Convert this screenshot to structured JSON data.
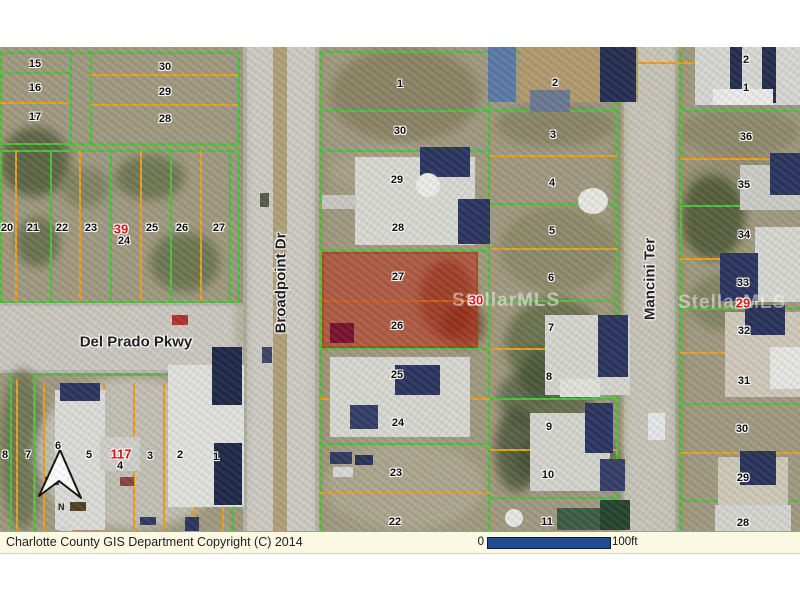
{
  "statusbar": {
    "copyright": "Charlotte County GIS Department Copyright (C) 2014",
    "scale_start": "0",
    "scale_end": "100ft"
  },
  "map": {
    "streets": {
      "broadpoint": "Broadpoint Dr",
      "delprado": "Del Prado Pkwy",
      "mancini": "Mancini Ter"
    },
    "watermark": "StellarMLS",
    "north_label": "N",
    "highlight": {
      "block": "30",
      "lots": [
        "27",
        "26"
      ]
    },
    "colors": {
      "green": "#4dc23f",
      "orange": "#eb9f1e",
      "highlight": "rgba(187,40,18,0.55)",
      "scalebar": "#1e4e90",
      "red_label": "#e00f0f"
    },
    "block_labels": [
      [
        "39",
        121,
        182
      ],
      [
        "117",
        121,
        407
      ],
      [
        "30",
        476,
        253
      ],
      [
        "29",
        743,
        256
      ]
    ],
    "lots": [
      [
        "15",
        35,
        17
      ],
      [
        "16",
        35,
        41
      ],
      [
        "17",
        35,
        70
      ],
      [
        "30",
        165,
        20
      ],
      [
        "29",
        165,
        45
      ],
      [
        "28",
        165,
        72
      ],
      [
        "20",
        7,
        181
      ],
      [
        "21",
        33,
        181
      ],
      [
        "22",
        62,
        181
      ],
      [
        "23",
        91,
        181
      ],
      [
        "24",
        124,
        194
      ],
      [
        "25",
        152,
        181
      ],
      [
        "26",
        182,
        181
      ],
      [
        "27",
        219,
        181
      ],
      [
        "8",
        5,
        408
      ],
      [
        "7",
        28,
        408
      ],
      [
        "6",
        58,
        399
      ],
      [
        "5",
        89,
        408
      ],
      [
        "4",
        120,
        419
      ],
      [
        "3",
        150,
        409
      ],
      [
        "2",
        180,
        408
      ],
      [
        "1",
        216,
        410
      ],
      [
        "1",
        400,
        37
      ],
      [
        "30",
        400,
        84
      ],
      [
        "29",
        397,
        133
      ],
      [
        "28",
        398,
        181
      ],
      [
        "27",
        398,
        230
      ],
      [
        "26",
        397,
        279
      ],
      [
        "25",
        397,
        328
      ],
      [
        "24",
        398,
        376
      ],
      [
        "23",
        396,
        426
      ],
      [
        "22",
        395,
        475
      ],
      [
        "2",
        555,
        36
      ],
      [
        "3",
        553,
        88
      ],
      [
        "4",
        552,
        136
      ],
      [
        "5",
        552,
        184
      ],
      [
        "6",
        551,
        231
      ],
      [
        "7",
        551,
        281
      ],
      [
        "8",
        549,
        330
      ],
      [
        "9",
        549,
        380
      ],
      [
        "10",
        548,
        428
      ],
      [
        "11",
        547,
        475
      ],
      [
        "2",
        746,
        13
      ],
      [
        "1",
        746,
        41
      ],
      [
        "36",
        746,
        90
      ],
      [
        "35",
        744,
        138
      ],
      [
        "34",
        744,
        188
      ],
      [
        "33",
        743,
        236
      ],
      [
        "32",
        744,
        284
      ],
      [
        "31",
        744,
        334
      ],
      [
        "30",
        742,
        382
      ],
      [
        "29",
        743,
        431
      ],
      [
        "28",
        743,
        476
      ]
    ],
    "lines": [
      [
        "g",
        0,
        5,
        240,
        2
      ],
      [
        "g",
        0,
        96,
        240,
        2
      ],
      [
        "g",
        0,
        5,
        2,
        93
      ],
      [
        "g",
        238,
        5,
        2,
        93
      ],
      [
        "g",
        70,
        5,
        2,
        93
      ],
      [
        "g",
        90,
        5,
        2,
        93
      ],
      [
        "g",
        0,
        25,
        70,
        2
      ],
      [
        "o",
        0,
        55,
        70,
        2
      ],
      [
        "o",
        90,
        27,
        148,
        2
      ],
      [
        "o",
        90,
        57,
        148,
        2
      ],
      [
        "g",
        0,
        103,
        240,
        2
      ],
      [
        "g",
        0,
        254,
        240,
        2
      ],
      [
        "g",
        0,
        103,
        2,
        153
      ],
      [
        "g",
        238,
        103,
        2,
        153
      ],
      [
        "o",
        15,
        103,
        2,
        151
      ],
      [
        "g",
        50,
        103,
        2,
        151
      ],
      [
        "o",
        79,
        103,
        2,
        151
      ],
      [
        "g",
        110,
        103,
        2,
        151
      ],
      [
        "o",
        140,
        103,
        2,
        151
      ],
      [
        "g",
        170,
        103,
        2,
        151
      ],
      [
        "o",
        200,
        103,
        2,
        151
      ],
      [
        "g",
        229,
        103,
        2,
        151
      ],
      [
        "g",
        10,
        326,
        2,
        158
      ],
      [
        "o",
        16,
        332,
        2,
        152
      ],
      [
        "o",
        43,
        336,
        2,
        148
      ],
      [
        "o",
        73,
        336,
        2,
        148
      ],
      [
        "o",
        103,
        336,
        2,
        148
      ],
      [
        "o",
        133,
        336,
        2,
        148
      ],
      [
        "o",
        163,
        336,
        2,
        148
      ],
      [
        "o",
        194,
        336,
        2,
        148
      ],
      [
        "o",
        222,
        336,
        2,
        148
      ],
      [
        "g",
        320,
        4,
        2,
        480
      ],
      [
        "g",
        616,
        4,
        2,
        480
      ],
      [
        "g",
        488,
        4,
        2,
        480
      ],
      [
        "g",
        320,
        4,
        298,
        2
      ],
      [
        "g",
        320,
        63,
        170,
        2
      ],
      [
        "g",
        320,
        103,
        170,
        2
      ],
      [
        "o",
        320,
        156,
        170,
        2
      ],
      [
        "g",
        320,
        203,
        170,
        2
      ],
      [
        "o",
        322,
        253,
        156,
        2
      ],
      [
        "g",
        320,
        301,
        170,
        2
      ],
      [
        "o",
        320,
        351,
        170,
        2
      ],
      [
        "g",
        320,
        396,
        170,
        2
      ],
      [
        "o",
        320,
        445,
        170,
        2
      ],
      [
        "g",
        490,
        63,
        128,
        2
      ],
      [
        "o",
        490,
        108,
        128,
        2
      ],
      [
        "g",
        490,
        156,
        128,
        2
      ],
      [
        "o",
        490,
        201,
        128,
        2
      ],
      [
        "g",
        490,
        253,
        128,
        2
      ],
      [
        "o",
        490,
        301,
        128,
        2
      ],
      [
        "g",
        490,
        351,
        128,
        2
      ],
      [
        "o",
        490,
        402,
        128,
        2
      ],
      [
        "g",
        490,
        450,
        128,
        2
      ],
      [
        "g",
        680,
        4,
        2,
        480
      ],
      [
        "o",
        606,
        15,
        194,
        2
      ],
      [
        "g",
        680,
        63,
        120,
        2
      ],
      [
        "o",
        680,
        111,
        120,
        2
      ],
      [
        "g",
        680,
        158,
        120,
        2
      ],
      [
        "o",
        680,
        211,
        120,
        2
      ],
      [
        "g",
        680,
        261,
        120,
        2
      ],
      [
        "o",
        606,
        305,
        16,
        2
      ],
      [
        "o",
        680,
        305,
        120,
        2
      ],
      [
        "g",
        680,
        356,
        120,
        2
      ],
      [
        "o",
        680,
        405,
        120,
        2
      ],
      [
        "g",
        680,
        453,
        120,
        2
      ]
    ],
    "buildings": [
      [
        355,
        110,
        120,
        88,
        "#d9d9d5"
      ],
      [
        420,
        100,
        50,
        30,
        "#2a3560"
      ],
      [
        458,
        152,
        32,
        45,
        "#2a3560"
      ],
      [
        416,
        126,
        24,
        24,
        "#ededea",
        "r"
      ],
      [
        578,
        141,
        30,
        26,
        "#e8e8e4",
        "r"
      ],
      [
        322,
        148,
        34,
        14,
        "#c9c7c0"
      ],
      [
        330,
        310,
        140,
        80,
        "#d8d8d4"
      ],
      [
        395,
        318,
        45,
        30,
        "#2a3560"
      ],
      [
        350,
        358,
        28,
        24,
        "#323c66"
      ],
      [
        330,
        405,
        22,
        12,
        "#303a62"
      ],
      [
        355,
        408,
        18,
        10,
        "#283258"
      ],
      [
        333,
        420,
        20,
        10,
        "#d8d8d8"
      ],
      [
        488,
        0,
        28,
        55,
        "#5b79a8"
      ],
      [
        520,
        0,
        118,
        55,
        "#b29a6d"
      ],
      [
        600,
        0,
        36,
        55,
        "#242e52"
      ],
      [
        530,
        43,
        40,
        22,
        "#6a7894"
      ],
      [
        545,
        268,
        85,
        80,
        "#d6d6d2"
      ],
      [
        598,
        268,
        30,
        62,
        "#2a3560"
      ],
      [
        560,
        332,
        40,
        18,
        "#e2e2de"
      ],
      [
        530,
        366,
        80,
        78,
        "#d4d4d0"
      ],
      [
        585,
        356,
        28,
        50,
        "#2a3560"
      ],
      [
        600,
        412,
        25,
        32,
        "#343e68"
      ],
      [
        557,
        461,
        70,
        22,
        "#3a5c46"
      ],
      [
        600,
        453,
        30,
        30,
        "#24442f"
      ],
      [
        505,
        462,
        18,
        18,
        "#e8e8e8",
        "r"
      ],
      [
        695,
        0,
        105,
        58,
        "#d8d8d5"
      ],
      [
        730,
        0,
        12,
        52,
        "#222c50"
      ],
      [
        762,
        0,
        14,
        56,
        "#222c50"
      ],
      [
        713,
        42,
        60,
        16,
        "#ececea"
      ],
      [
        740,
        118,
        60,
        45,
        "#cdcdc8"
      ],
      [
        770,
        106,
        30,
        42,
        "#2a3560"
      ],
      [
        755,
        180,
        45,
        75,
        "#d7d7d3"
      ],
      [
        720,
        206,
        38,
        48,
        "#2a3560"
      ],
      [
        725,
        265,
        75,
        85,
        "#cfcabb"
      ],
      [
        745,
        258,
        40,
        30,
        "#28325a"
      ],
      [
        770,
        300,
        30,
        42,
        "#e8e8e6"
      ],
      [
        718,
        410,
        70,
        76,
        "#cfc9ba"
      ],
      [
        740,
        404,
        36,
        34,
        "#28325a"
      ],
      [
        648,
        366,
        17,
        27,
        "#e6e8ea"
      ],
      [
        715,
        458,
        76,
        26,
        "#d5d5d1"
      ],
      [
        55,
        343,
        50,
        140,
        "#dcdcda"
      ],
      [
        60,
        336,
        40,
        18,
        "#2a3560"
      ],
      [
        168,
        318,
        76,
        142,
        "#e2e2e0"
      ],
      [
        212,
        300,
        30,
        58,
        "#1e2848"
      ],
      [
        214,
        396,
        28,
        62,
        "#1e2848"
      ],
      [
        100,
        390,
        40,
        34,
        "#d0d0cc"
      ],
      [
        172,
        268,
        16,
        10,
        "#b03030"
      ],
      [
        45,
        430,
        14,
        8,
        "#303a62"
      ],
      [
        70,
        455,
        16,
        9,
        "#50421e"
      ],
      [
        120,
        430,
        14,
        9,
        "#884444"
      ],
      [
        140,
        470,
        16,
        8,
        "#303a62"
      ],
      [
        95,
        500,
        18,
        9,
        "#25304f"
      ],
      [
        150,
        505,
        15,
        8,
        "#c8c8c4"
      ],
      [
        185,
        470,
        14,
        20,
        "#2b355c"
      ],
      [
        60,
        478,
        12,
        8,
        "#d8d8d8"
      ],
      [
        262,
        300,
        10,
        16,
        "#3a4468"
      ],
      [
        260,
        146,
        9,
        14,
        "#555b4a"
      ],
      [
        330,
        276,
        24,
        20,
        "#7a1030"
      ]
    ],
    "veg": [
      [
        0,
        80,
        70,
        70,
        "#4e5a38",
        0.8
      ],
      [
        115,
        108,
        70,
        45,
        "#5d6a42",
        0.7
      ],
      [
        150,
        185,
        70,
        60,
        "#5f6c44",
        0.75
      ],
      [
        15,
        170,
        45,
        50,
        "#56633c",
        0.7
      ],
      [
        60,
        120,
        50,
        40,
        "#6d7850",
        0.6
      ],
      [
        330,
        0,
        150,
        95,
        "#8a8263",
        0.9
      ],
      [
        495,
        55,
        120,
        45,
        "#7d7a58",
        0.6
      ],
      [
        500,
        160,
        115,
        85,
        "#83815f",
        0.65
      ],
      [
        505,
        250,
        100,
        95,
        "#5c6840",
        0.75
      ],
      [
        498,
        318,
        95,
        65,
        "#515d3a",
        0.7
      ],
      [
        515,
        385,
        105,
        55,
        "#495533",
        0.75
      ],
      [
        683,
        108,
        115,
        50,
        "#8a8768",
        0.6
      ],
      [
        680,
        128,
        65,
        85,
        "#46522f",
        0.8
      ],
      [
        688,
        225,
        85,
        60,
        "#707853",
        0.6
      ],
      [
        0,
        322,
        45,
        160,
        "#5e6a42",
        0.7
      ],
      [
        612,
        0,
        12,
        484,
        "#7f885c",
        0.55
      ],
      [
        676,
        0,
        8,
        484,
        "#7f885c",
        0.5
      ],
      [
        237,
        0,
        8,
        484,
        "#8c8c64",
        0.5
      ],
      [
        317,
        0,
        8,
        484,
        "#8c8c64",
        0.45
      ],
      [
        680,
        60,
        120,
        50,
        "#7b7b58",
        0.5
      ],
      [
        330,
        100,
        150,
        50,
        "#aba489",
        0.8
      ],
      [
        325,
        395,
        160,
        88,
        "#b1ac94",
        0.7
      ],
      [
        35,
        330,
        195,
        152,
        "#c9c7bf",
        0.85
      ],
      [
        420,
        212,
        55,
        80,
        "#5e1e08",
        0.5
      ],
      [
        443,
        256,
        42,
        44,
        "#561a06",
        0.5
      ],
      [
        495,
        360,
        45,
        85,
        "#3c4a2c",
        0.7
      ],
      [
        520,
        300,
        40,
        55,
        "#435130",
        0.65
      ]
    ],
    "watermarks": [
      {
        "x": 452,
        "y": 243
      },
      {
        "x": 678,
        "y": 245
      }
    ],
    "label_positions": {
      "broadpoint": {
        "x": 281,
        "y": 236
      },
      "delprado": {
        "x": 136,
        "y": 295
      },
      "mancini": {
        "x": 650,
        "y": 232
      }
    }
  }
}
